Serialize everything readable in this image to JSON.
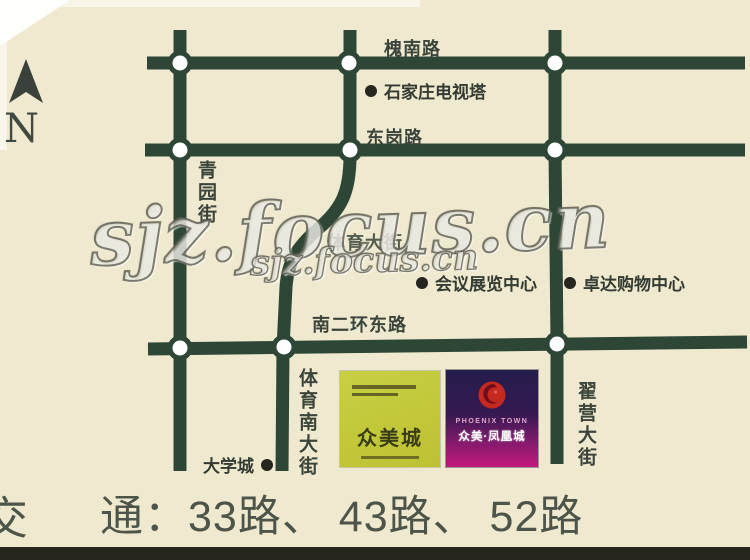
{
  "compass": {
    "letter": "N"
  },
  "watermark": {
    "large": "sjz.focus.cn",
    "small": "sjz.focus.cn"
  },
  "roads": [
    {
      "id": "huainan",
      "label": "槐南路",
      "orientation": "horizontal"
    },
    {
      "id": "donggang",
      "label": "东岗路",
      "orientation": "horizontal"
    },
    {
      "id": "nanerhuan",
      "label": "南二环东路",
      "orientation": "horizontal"
    },
    {
      "id": "qingyuan",
      "label": "青园街",
      "orientation": "vertical"
    },
    {
      "id": "tiyu",
      "label": "体育大街",
      "orientation": "horizontal-obscured"
    },
    {
      "id": "tiyu-south",
      "label": "体育南大街",
      "orientation": "vertical"
    },
    {
      "id": "zhaiying",
      "label": "翟营大街",
      "orientation": "vertical"
    }
  ],
  "pois": [
    {
      "label": "石家庄电视塔"
    },
    {
      "label": "会议展览中心"
    },
    {
      "label": "卓达购物中心"
    },
    {
      "label": "大学城"
    }
  ],
  "logos": {
    "zhongmei": {
      "name": "众美城"
    },
    "phoenix": {
      "en_name": "PHOENIX TOWN",
      "cn_name": "众美·凤凰城"
    }
  },
  "footer": {
    "part1": "交",
    "part2": "通：33路、 43路、 52路"
  },
  "colors": {
    "background": "#efe9cf",
    "road": "#2e4636",
    "logo_yellow": "#c2c838",
    "logo_purple_bottom": "#c2187c",
    "phoenix_red": "#c5291f"
  }
}
